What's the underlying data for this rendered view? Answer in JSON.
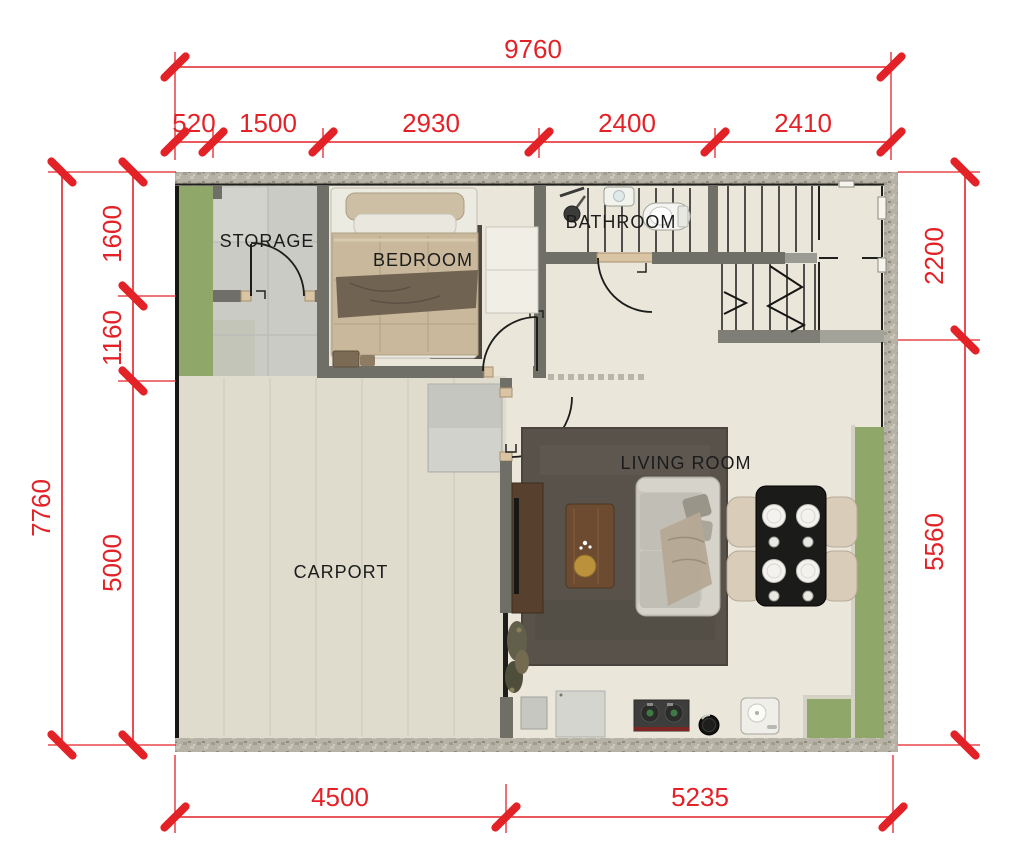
{
  "title": "House floor plan with dimensions",
  "colors": {
    "dim-red": "#e32228",
    "wall-dark": "#6f6f67",
    "wall-texture": "#b6b3a6",
    "floor-cream": "#eae6d9",
    "floor-carport": "#e0dccd",
    "floor-tile": "#cbcbc6",
    "garden-green": "#8fa768",
    "rug-dark": "#58524b"
  },
  "rooms": {
    "storage": "STORAGE",
    "bedroom": "BEDROOM",
    "bathroom": "BATHROOM",
    "living_room": "LIVING ROOM",
    "carport": "CARPORT"
  },
  "dimensions": {
    "top": {
      "total": "9760",
      "segments": [
        "520",
        "1500",
        "2930",
        "2400",
        "2410"
      ]
    },
    "left": {
      "total": "7760",
      "segments": [
        "1600",
        "1160",
        "5000"
      ]
    },
    "right": {
      "segments": [
        "2200",
        "5560"
      ]
    },
    "bottom": {
      "segments": [
        "4500",
        "5235"
      ]
    }
  }
}
